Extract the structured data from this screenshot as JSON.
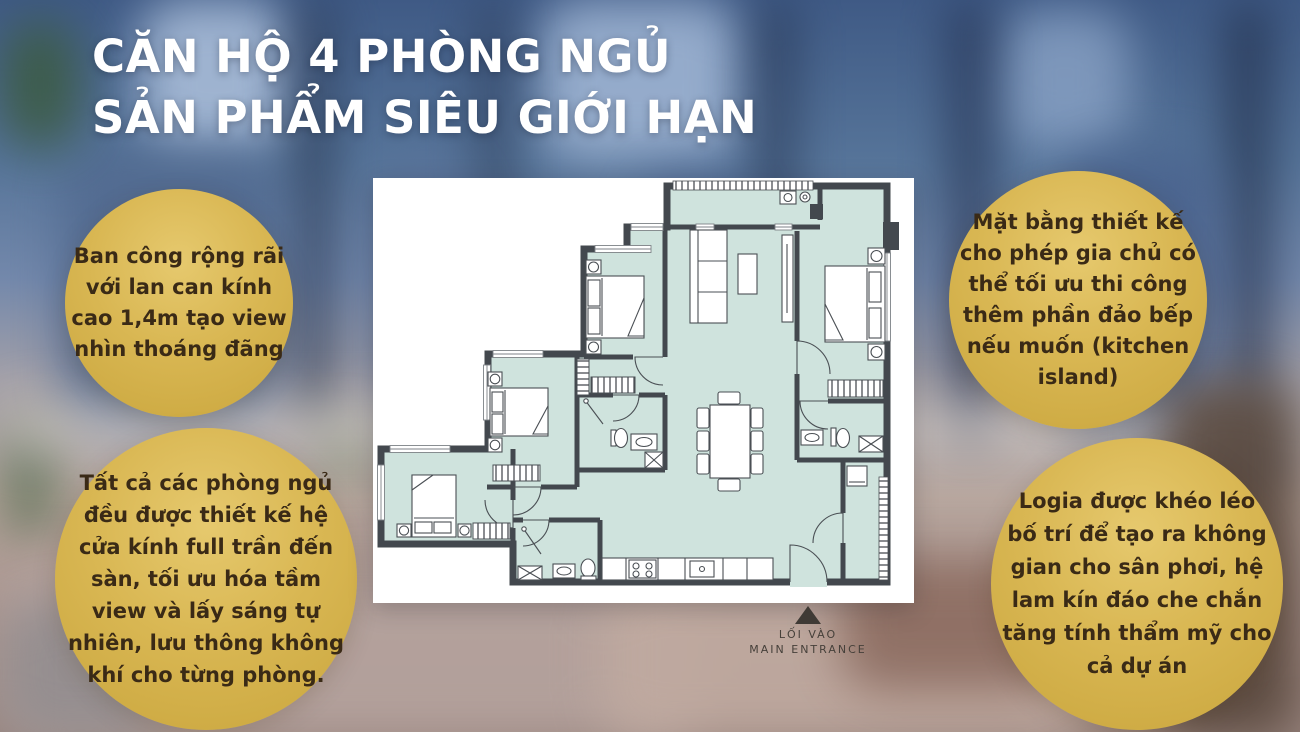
{
  "title": {
    "line1": "CĂN HỘ 4 PHÒNG NGỦ",
    "line2": "SẢN PHẨM SIÊU GIỚI HẠN"
  },
  "callouts": {
    "top_left": "Ban công rộng rãi với lan can kính cao 1,4m tạo view nhìn thoáng đãng",
    "top_right": "Mặt bằng thiết kế cho phép gia chủ có thể tối ưu thi công thêm phần đảo bếp nếu muốn (kitchen island)",
    "bottom_left": "Tất cả các phòng ngủ đều được thiết kế hệ cửa kính full trần đến sàn, tối ưu hóa tầm view và lấy sáng tự nhiên, lưu thông không khí cho từng phòng.",
    "bottom_right": "Logia được khéo léo bố trí để tạo ra không gian cho sân phơi, hệ lam kín đáo che chắn tăng tính thẩm mỹ cho cả dự án"
  },
  "floor_plan": {
    "entrance_label_vi": "LỐI VÀO",
    "entrance_label_en": "MAIN ENTRANCE"
  },
  "colors": {
    "gold_badge": "#d9b753",
    "badge_text": "#3a2a16",
    "title_text": "#ffffff",
    "plan_floor": "#cfe3dd",
    "plan_wall": "#43484e",
    "panel_background": "#ffffff"
  }
}
